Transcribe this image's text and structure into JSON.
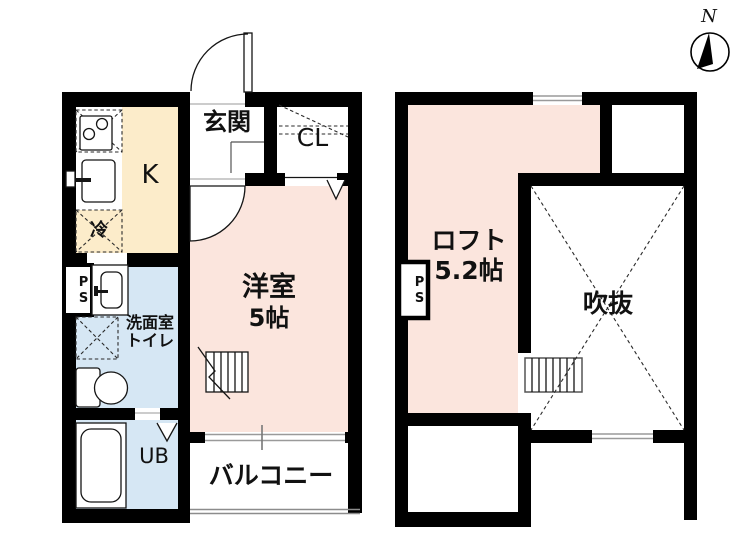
{
  "compass": {
    "north_label": "N"
  },
  "floor1": {
    "entrance": "玄関",
    "closet": "CL",
    "kitchen": "K",
    "refrigerator": "冷",
    "pipe_space": "PS",
    "western_room": {
      "name": "洋室",
      "size": "5帖"
    },
    "washroom": {
      "line1": "洗面室",
      "line2": "トイレ"
    },
    "unit_bath": "UB",
    "balcony": "バルコニー"
  },
  "floor2": {
    "loft": {
      "name": "ロフト",
      "size": "5.2帖"
    },
    "void": "吹抜",
    "pipe_space": "PS"
  },
  "colors": {
    "room-pink": "#fbe5dd",
    "room-cream": "#fcecca",
    "room-blue": "#d6e7f4",
    "wall": "#000000",
    "window-line": "#9a9a9a",
    "balcony-line": "#8c8c8c"
  }
}
